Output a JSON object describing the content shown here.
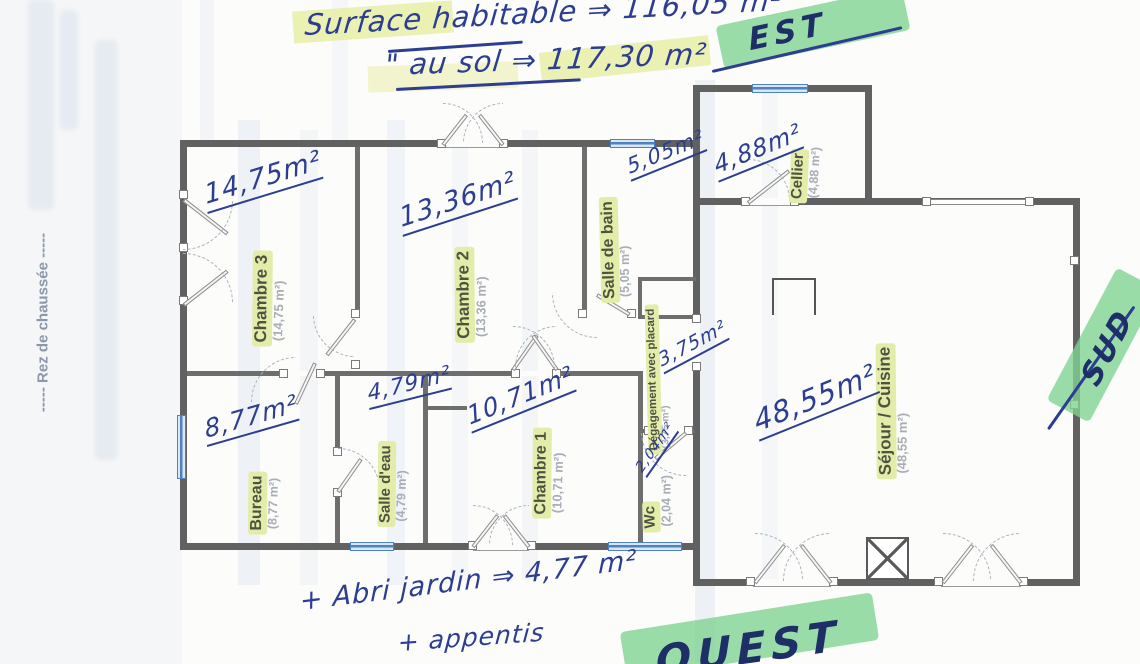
{
  "document": {
    "type_note": "scanned hand-annotated floor plan",
    "floor_label": "----- Rez de chaussée -----"
  },
  "summary": {
    "habitable": "Surface habitable ⇒ 116,05 m²",
    "au_sol": "\" au sol ⇒ 117,30 m²"
  },
  "extras": {
    "abri": "+ Abri jardin ⇒ 4,77 m²",
    "appentis": "+ appentis"
  },
  "directions": {
    "est": "EST",
    "sud": "SUD",
    "ouest": "OUEST"
  },
  "rooms": {
    "chambre3": {
      "name": "Chambre 3",
      "area": "(14,75 m²)",
      "hw": "14,75m²"
    },
    "chambre2": {
      "name": "Chambre 2",
      "area": "(13,36 m²)",
      "hw": "13,36m²"
    },
    "salle_de_bain": {
      "name": "Salle de bain",
      "area": "(5,05 m²)",
      "hw": "5,05m²"
    },
    "cellier": {
      "name": "Cellier",
      "area": "(4,88 m²)",
      "hw": "4,88m²"
    },
    "sejour": {
      "name": "Séjour / Cuisine",
      "area": "(48,55 m²)",
      "hw": "48,55m²"
    },
    "bureau": {
      "name": "Bureau",
      "area": "(8,77 m²)",
      "hw": "8,77m²"
    },
    "salle_deau": {
      "name": "Salle d'eau",
      "area": "(4,79 m²)",
      "hw": "4,79m²"
    },
    "chambre1": {
      "name": "Chambre 1",
      "area": "(10,71 m²)",
      "hw": "10,71m²"
    },
    "wc": {
      "name": "Wc",
      "area": "(2,04 m²)",
      "hw": "2,04m²"
    },
    "degagement": {
      "name": "Dégagement avec placard",
      "area": "(3,75 m²)",
      "hw": "3,75m²"
    }
  },
  "colors": {
    "ink_blue": "#2c3d92",
    "highlight_yellow": "#e7eda6",
    "highlight_green": "#7fd392",
    "wall_gray": "#616161",
    "window_blue": "#4f82c2",
    "label_olive": "#4d5340"
  }
}
